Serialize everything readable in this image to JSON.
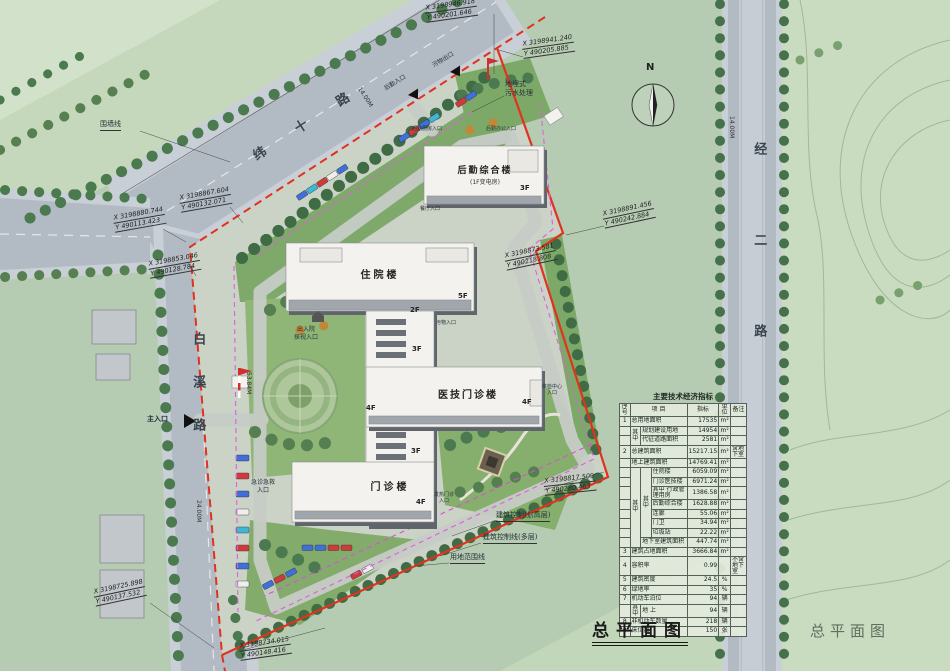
{
  "titles": {
    "main": "总平面图",
    "watermark": "总平面图"
  },
  "compass": {
    "north": "N"
  },
  "roads": {
    "weishi": {
      "name": "纬 十 路",
      "width": "14.00M"
    },
    "baixi": {
      "name": "白溪路",
      "width": "24.00M"
    },
    "jinger": {
      "name": "经二路",
      "width": "14.00M"
    }
  },
  "dims": {
    "site_west": "53.84M"
  },
  "coords": [
    {
      "x": "X 3198946.918",
      "y": "Y 490201.646"
    },
    {
      "x": "X 3198941.240",
      "y": "Y 490205.885"
    },
    {
      "x": "X 3198867.604",
      "y": "Y 490132.071"
    },
    {
      "x": "X 3198880.744",
      "y": "Y 490113.423"
    },
    {
      "x": "X 3198853.046",
      "y": "Y 490128.784"
    },
    {
      "x": "X 3198891.456",
      "y": "Y 490242.884"
    },
    {
      "x": "X 3198873.581",
      "y": "Y 490218.808"
    },
    {
      "x": "X 3198817.509",
      "y": "Y 490280.463"
    },
    {
      "x": "X 3198725.898",
      "y": "Y 490137.532"
    },
    {
      "x": "X 3198734.015",
      "y": "Y 490148.416"
    }
  ],
  "buildings": {
    "houqin": {
      "name": "后勤综合楼",
      "sub": "(1F变电房)"
    },
    "zhuyuan": {
      "name": "住院楼"
    },
    "yiji": {
      "name": "医技门诊楼"
    },
    "menzhen": {
      "name": "门诊楼"
    }
  },
  "floors": [
    "3F",
    "5F",
    "2F",
    "3F",
    "4F",
    "4F",
    "3F",
    "4F"
  ],
  "labels": {
    "wall_line": "围墙线",
    "sewage": "地埋式\n污水处理",
    "houqin_entrance": "后勤入口",
    "waste_exit": "污物出口",
    "houqin_office": "后勤办公入口",
    "houqin_kitchen": "后勤厨房入口",
    "canteen": "餐厅入口",
    "admission": "出入院\n探视入口",
    "waste_in": "污物入口",
    "checkup": "体检中心\n入口",
    "emergency": "急诊急救\n入口",
    "fever": "发热门诊\n入口",
    "main_entrance": "主入口",
    "ctrl_high": "建筑控制线(高层)",
    "ctrl_multi": "建筑控制线(多层)",
    "site_red_line": "用地范围线"
  },
  "table": {
    "title": "主要技术经济指标",
    "qz": "其中",
    "headers": {
      "no": "序号",
      "item": "项  目",
      "value": "指标",
      "unit": "单位",
      "note": "备注"
    },
    "rows": [
      {
        "no": "1",
        "item": "总用地面积",
        "val": "17535",
        "unit": "m²",
        "note": ""
      },
      {
        "no": "",
        "item": "规划建设用地",
        "val": "14954",
        "unit": "m²",
        "note": ""
      },
      {
        "no": "",
        "item": "代征道路面积",
        "val": "2581",
        "unit": "m²",
        "note": ""
      },
      {
        "no": "2",
        "item": "总建筑面积",
        "val": "15217.15",
        "unit": "m²",
        "note": "含地下室"
      },
      {
        "no": "",
        "item": "地上建筑面积",
        "val": "14769.41",
        "unit": "m²",
        "note": ""
      },
      {
        "no": "",
        "item": "住院楼",
        "val": "6059.09",
        "unit": "m²",
        "note": ""
      },
      {
        "no": "",
        "item": "门诊医技楼",
        "val": "6971.24",
        "unit": "m²",
        "note": ""
      },
      {
        "no": "",
        "item": "其中 行政管理用房",
        "val": "1386.58",
        "unit": "m²",
        "note": ""
      },
      {
        "no": "",
        "item": "后勤综合楼",
        "val": "1628.88",
        "unit": "m²",
        "note": ""
      },
      {
        "no": "",
        "item": "连廊",
        "val": "55.06",
        "unit": "m²",
        "note": ""
      },
      {
        "no": "",
        "item": "门卫",
        "val": "34.94",
        "unit": "m²",
        "note": ""
      },
      {
        "no": "",
        "item": "垃圾站",
        "val": "22.22",
        "unit": "m²",
        "note": ""
      },
      {
        "no": "",
        "item": "地下室建筑面积",
        "val": "447.74",
        "unit": "m²",
        "note": ""
      },
      {
        "no": "3",
        "item": "建筑占地面积",
        "val": "3666.84",
        "unit": "m²",
        "note": ""
      },
      {
        "no": "4",
        "item": "容积率",
        "val": "0.99",
        "unit": "",
        "note": "不含地下室"
      },
      {
        "no": "5",
        "item": "建筑密度",
        "val": "24.5",
        "unit": "%",
        "note": ""
      },
      {
        "no": "6",
        "item": "绿地率",
        "val": "35",
        "unit": "%",
        "note": ""
      },
      {
        "no": "7",
        "item": "机动车泊位",
        "val": "94",
        "unit": "辆",
        "note": ""
      },
      {
        "no": "",
        "item": "地 上",
        "val": "94",
        "unit": "辆",
        "note": ""
      },
      {
        "no": "8",
        "item": "非机动车数量",
        "val": "218",
        "unit": "辆",
        "note": ""
      },
      {
        "no": "9",
        "item": "床位数",
        "val": "150",
        "unit": "张",
        "note": ""
      }
    ]
  }
}
